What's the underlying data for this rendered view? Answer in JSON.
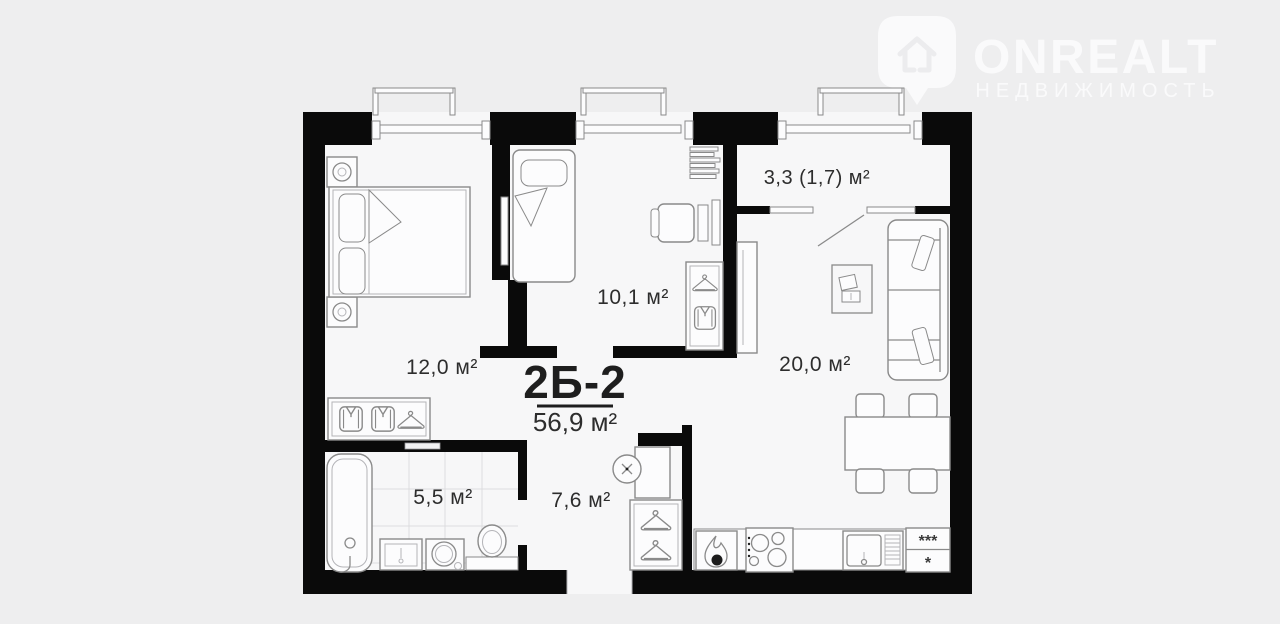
{
  "watermark": {
    "brand": "ONREALT",
    "subtitle": "НЕДВИЖИМОСТЬ"
  },
  "plan": {
    "title": "2Б-2",
    "total_area": "56,9 м²",
    "rooms": [
      {
        "id": "bedroom",
        "label": "12,0 м²"
      },
      {
        "id": "kids-room",
        "label": "10,1 м²"
      },
      {
        "id": "balcony",
        "label": "3,3 (1,7) м²"
      },
      {
        "id": "living-kitchen",
        "label": "20,0 м²"
      },
      {
        "id": "bathroom",
        "label": "5,5 м²"
      },
      {
        "id": "hallway",
        "label": "7,6 м²"
      }
    ],
    "fridge": {
      "top": "***",
      "bottom": "*"
    }
  },
  "colors": {
    "background": "#eeeeef",
    "floor": "#f7f7f8",
    "wall": "#0a0a0a",
    "line": "#8a8a8a",
    "text": "#2d2d2d",
    "watermark": "#fafafb"
  }
}
